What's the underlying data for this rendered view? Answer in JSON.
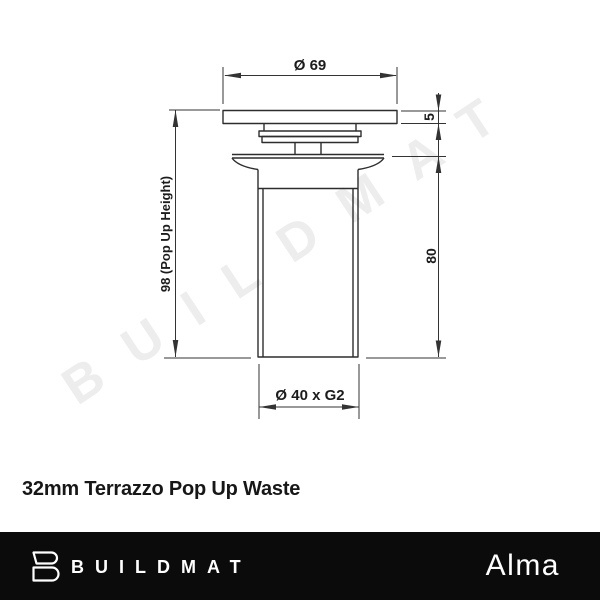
{
  "watermark": {
    "text": "BUILDMAT"
  },
  "diagram": {
    "dim_diameter_top": "Ø 69",
    "dim_plate_thickness": "5",
    "dim_popup_height": "98 (Pop Up Height)",
    "dim_body_height": "80",
    "dim_thread": "Ø 40 x G2"
  },
  "caption": {
    "title": "32mm Terrazzo Pop Up Waste"
  },
  "footer": {
    "brand": "BUILDMAT",
    "series": "Alma"
  },
  "colors": {
    "line": "#2d2d2d",
    "dim_text": "#1c1c1c",
    "watermark": "#ededed",
    "footer_bg": "#0b0b0b",
    "footer_text": "#ffffff"
  }
}
